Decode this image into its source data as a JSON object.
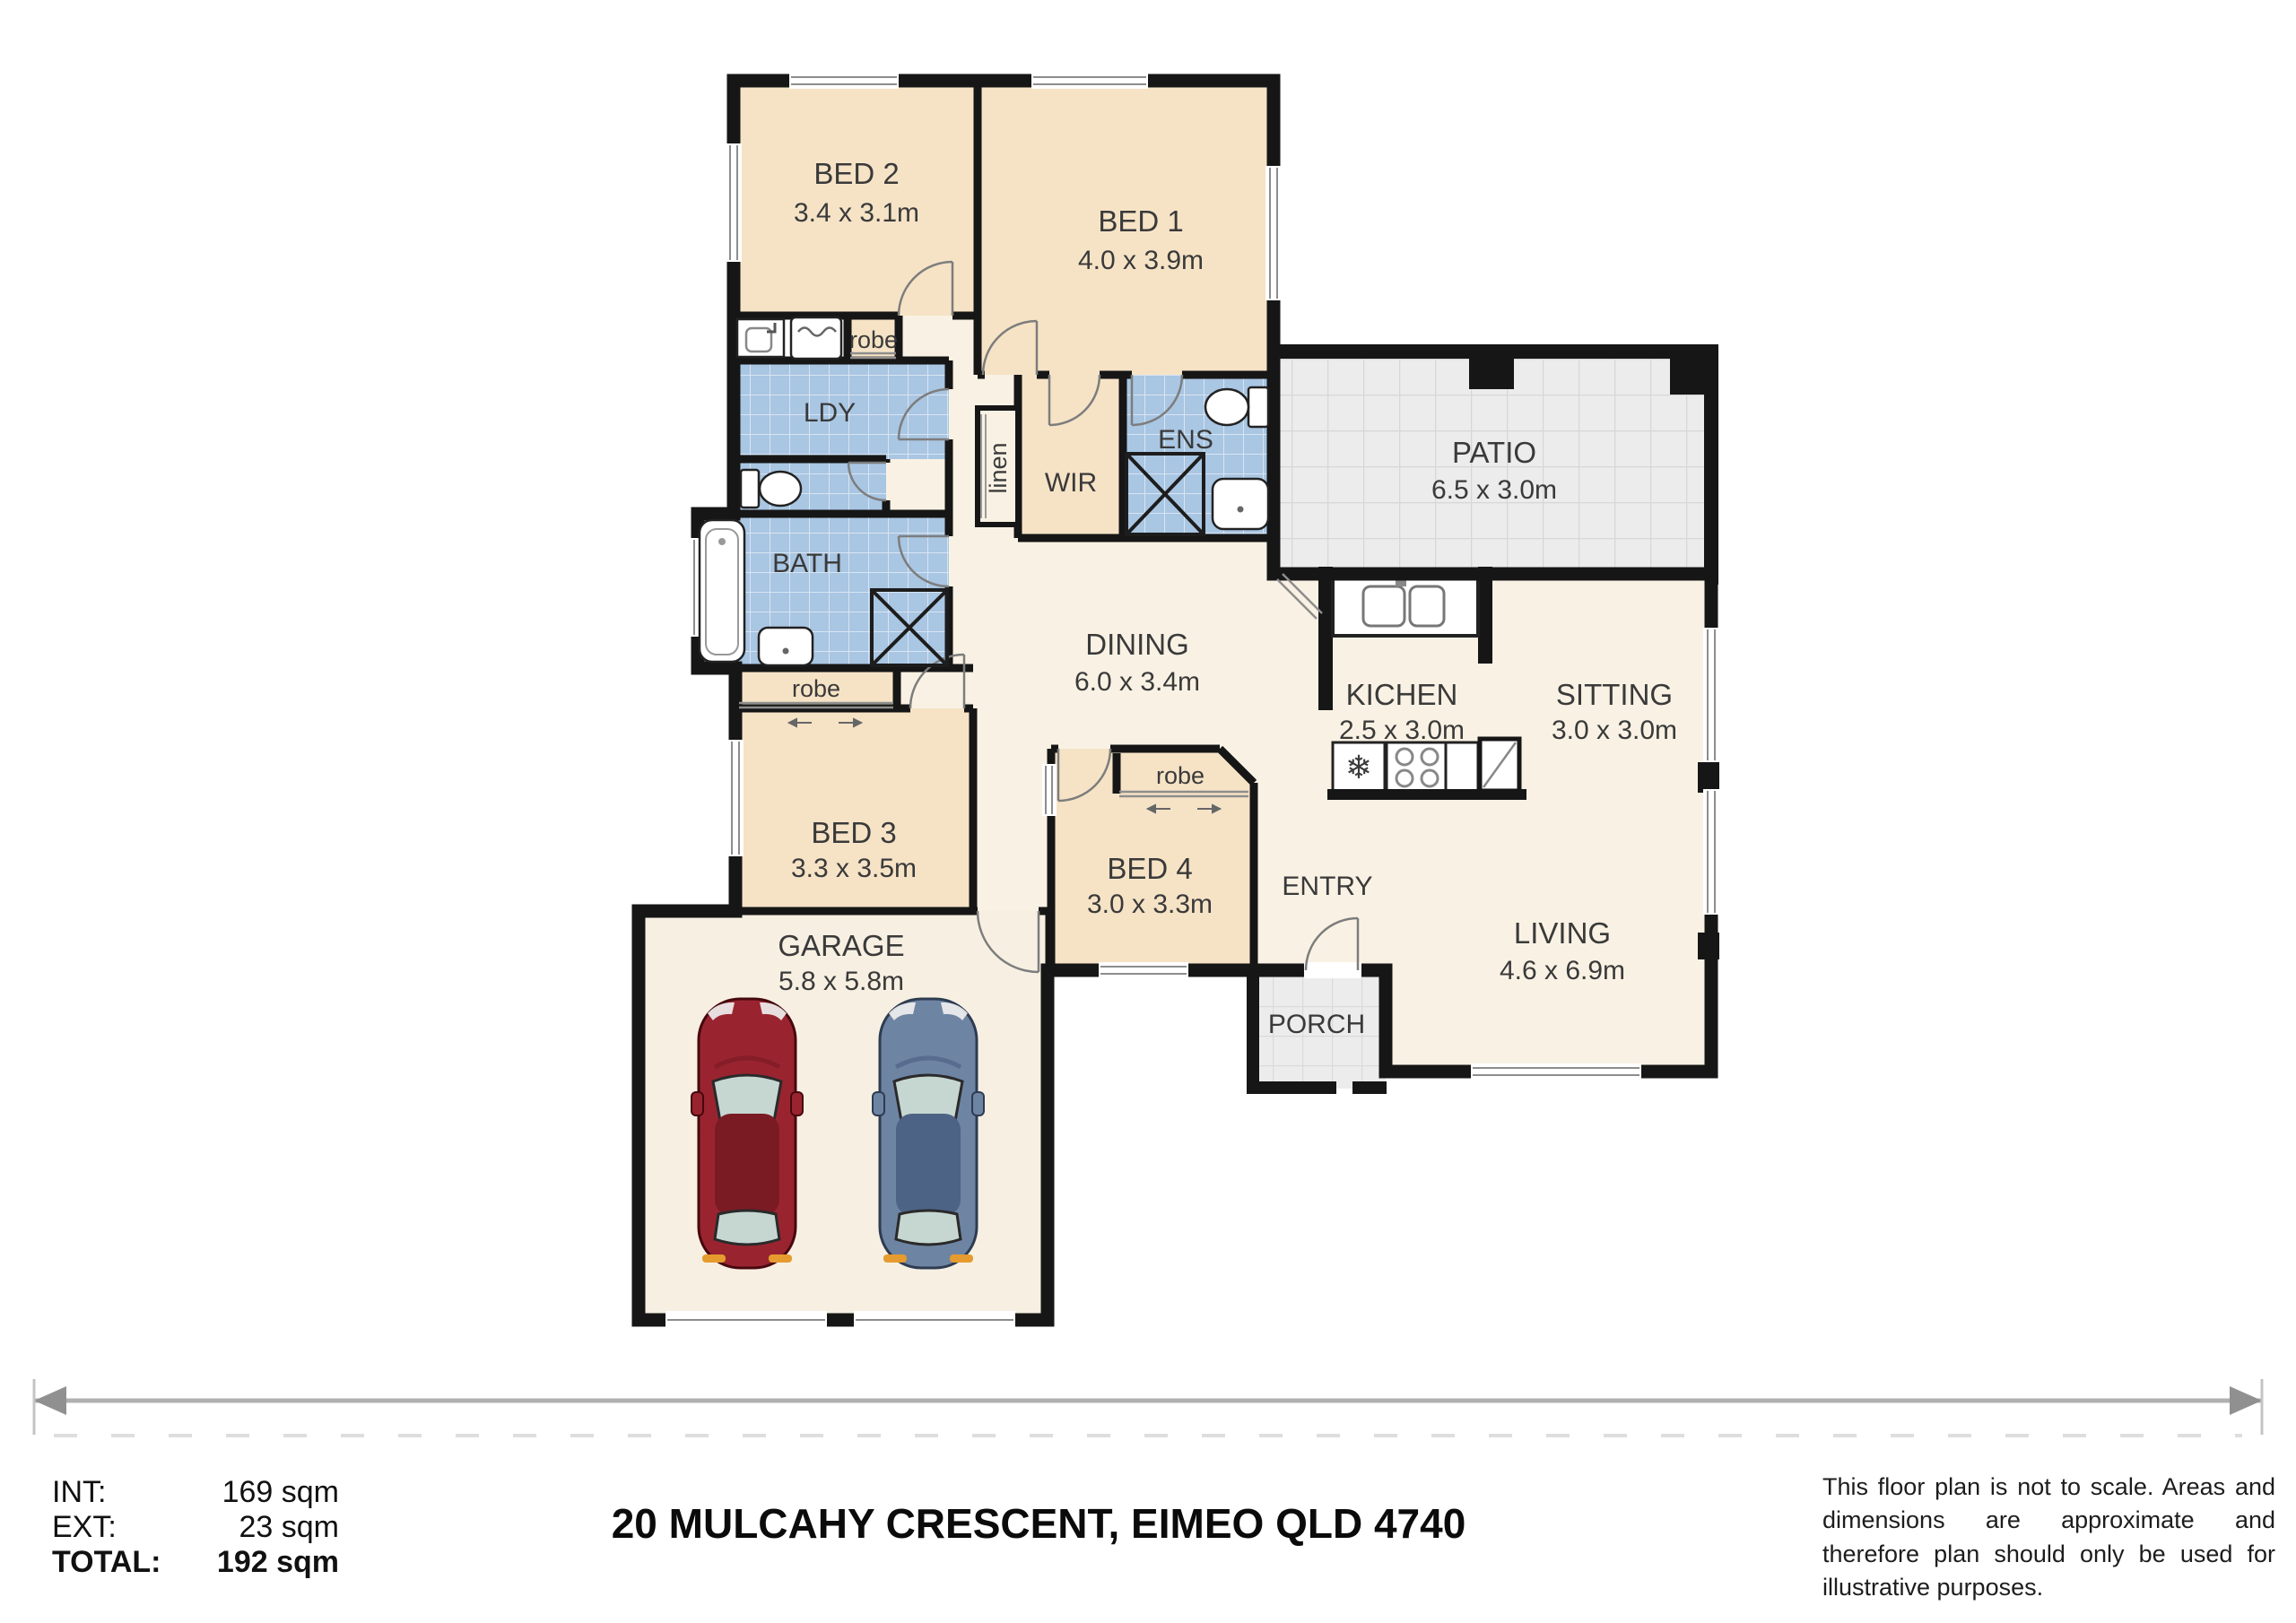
{
  "plan": {
    "rooms": {
      "bed1": {
        "name": "BED 1",
        "dims": "4.0 x 3.9m"
      },
      "bed2": {
        "name": "BED 2",
        "dims": "3.4 x 3.1m"
      },
      "bed3": {
        "name": "BED 3",
        "dims": "3.3 x 3.5m"
      },
      "bed4": {
        "name": "BED 4",
        "dims": "3.0 x 3.3m"
      },
      "patio": {
        "name": "PATIO",
        "dims": "6.5 x 3.0m"
      },
      "dining": {
        "name": "DINING",
        "dims": "6.0 x 3.4m"
      },
      "kitchen": {
        "name": "KICHEN",
        "dims": "2.5 x 3.0m"
      },
      "sitting": {
        "name": "SITTING",
        "dims": "3.0 x 3.0m"
      },
      "living": {
        "name": "LIVING",
        "dims": "4.6 x 6.9m"
      },
      "garage": {
        "name": "GARAGE",
        "dims": "5.8 x 5.8m"
      },
      "entry": {
        "name": "ENTRY"
      },
      "porch": {
        "name": "PORCH"
      },
      "laundry": {
        "name": "LDY"
      },
      "bath": {
        "name": "BATH"
      },
      "ensuite": {
        "name": "ENS"
      },
      "wir": {
        "name": "WIR"
      },
      "linen": {
        "name": "linen"
      },
      "robe": {
        "name": "robe"
      }
    },
    "colors": {
      "wall": "#161616",
      "bedroom_fill": "#f6e3c6",
      "floor_fill": "#f9f2e4",
      "garage_fill": "#f7f0e2",
      "wet_area_fill": "#a9c6e3",
      "patio_fill": "#ececec",
      "car_red": "#992430",
      "car_blue": "#6e84a3",
      "glass": "#c6d7d2",
      "indicator_orange": "#e59b2e",
      "scale_arrow": "#a8a8a8"
    }
  },
  "footer": {
    "areas": {
      "int_label": "INT:",
      "int_value": "169 sqm",
      "ext_label": "EXT:",
      "ext_value": "23 sqm",
      "total_label": "TOTAL:",
      "total_value": "192 sqm"
    },
    "title": "20 MULCAHY CRESCENT, EIMEO QLD 4740",
    "disclaimer": "This floor plan is not to scale. Areas and dimensions are approximate and therefore plan should only be used for illustrative purposes."
  }
}
